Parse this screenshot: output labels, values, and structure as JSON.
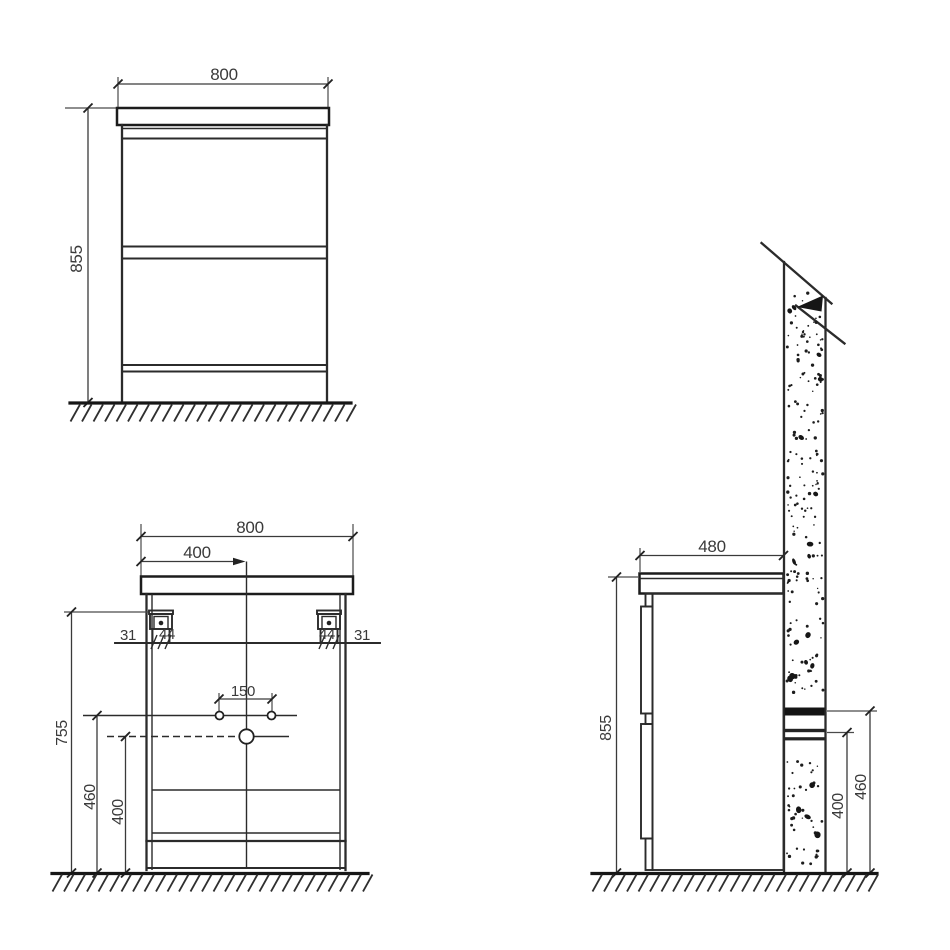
{
  "colors": {
    "line": "#2b2b2b",
    "text": "#3a3a3a",
    "background": "#ffffff"
  },
  "front_view": {
    "width": "800",
    "height": "855"
  },
  "installation_view": {
    "width": "800",
    "center_to_edge": "400",
    "left_wall_gap": "31",
    "left_bracket_width": "44",
    "right_bracket_width": "44",
    "right_wall_gap": "31",
    "faucet_hole_spacing": "150",
    "bracket_mount_height": "755",
    "water_inlet_height": "460",
    "drain_height": "400"
  },
  "side_view": {
    "depth": "480",
    "height": "855",
    "water_inlet_height": "460",
    "drain_height": "400"
  }
}
